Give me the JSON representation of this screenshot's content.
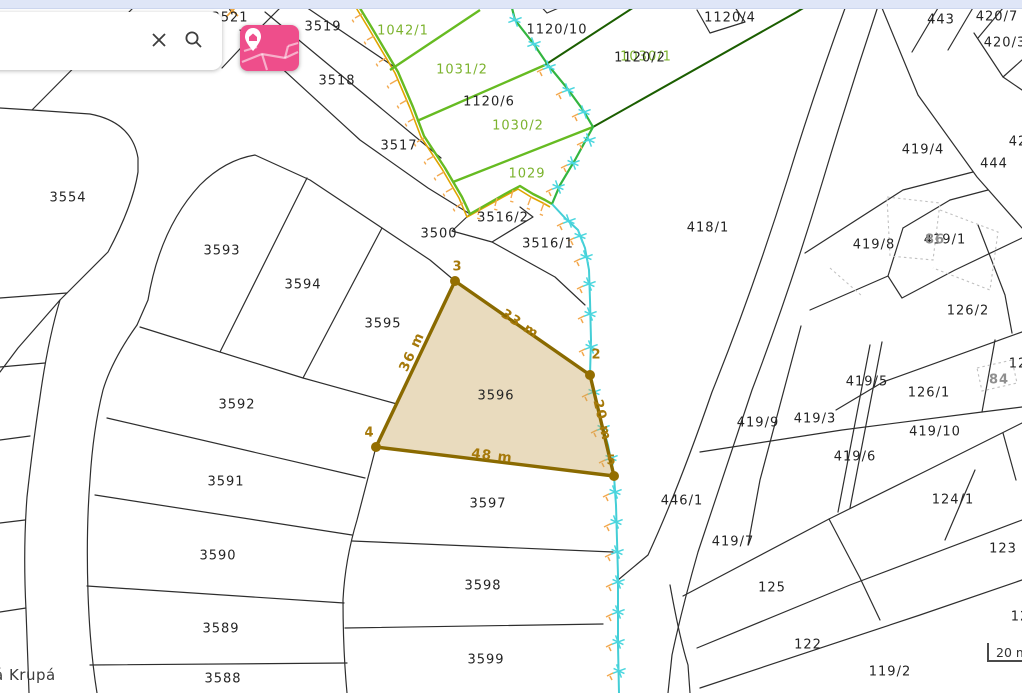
{
  "ui": {
    "search": {
      "placeholder": "",
      "value": "",
      "clear_label": "clear",
      "search_label": "search"
    },
    "map_style_button": {
      "label": "map style / base layer switcher"
    },
    "place_label": "á Krupá",
    "scalebar": {
      "label": "20 m"
    }
  },
  "map": {
    "colors": {
      "parcel_line": "#2e2e2e",
      "green_line": "#66bb22",
      "dark_green_line": "#1b5e00",
      "survey_green": "#33b540",
      "survey_cyan": "#44ced6",
      "marker_cyan": "#4ad6de",
      "tick_orange": "#f3a94f",
      "gold_line": "#e0a400",
      "highlight_stroke": "#8a6a00",
      "highlight_fill": "rgba(201,164,92,0.40)",
      "building_dash": "#c0c0c0"
    },
    "highlight": {
      "parcel_number": "3596",
      "vertices": [
        {
          "n": "3",
          "x": 455,
          "y": 281,
          "lx": 457,
          "ly": 267
        },
        {
          "n": "2",
          "x": 590,
          "y": 375,
          "lx": 596,
          "ly": 355
        },
        {
          "n": "5",
          "x": 614,
          "y": 476,
          "lx": 611,
          "ly": 461
        },
        {
          "n": "4",
          "x": 376,
          "y": 447,
          "lx": 369,
          "ly": 433
        }
      ],
      "measurements": [
        {
          "t": "33 m",
          "x": 520,
          "y": 324,
          "r": 33
        },
        {
          "t": "36 m",
          "x": 412,
          "y": 352,
          "r": -65
        },
        {
          "t": "20 m",
          "x": 602,
          "y": 420,
          "r": 77
        },
        {
          "t": "48 m",
          "x": 492,
          "y": 456,
          "r": 7
        }
      ]
    },
    "labels": [
      {
        "t": "3521",
        "x": 230,
        "y": 18,
        "c": "plabel"
      },
      {
        "t": "3519",
        "x": 323,
        "y": 27,
        "c": "plabel"
      },
      {
        "t": "3518",
        "x": 337,
        "y": 81,
        "c": "plabel"
      },
      {
        "t": "3517",
        "x": 399,
        "y": 146,
        "c": "plabel"
      },
      {
        "t": "3500",
        "x": 439,
        "y": 234,
        "c": "plabel"
      },
      {
        "t": "3516/2",
        "x": 503,
        "y": 218,
        "c": "plabel"
      },
      {
        "t": "3516/1",
        "x": 548,
        "y": 244,
        "c": "plabel"
      },
      {
        "t": "3554",
        "x": 68,
        "y": 198,
        "c": "plabel"
      },
      {
        "t": "3593",
        "x": 222,
        "y": 251,
        "c": "plabel"
      },
      {
        "t": "3594",
        "x": 303,
        "y": 285,
        "c": "plabel"
      },
      {
        "t": "3595",
        "x": 383,
        "y": 324,
        "c": "plabel"
      },
      {
        "t": "3592",
        "x": 237,
        "y": 405,
        "c": "plabel"
      },
      {
        "t": "3591",
        "x": 226,
        "y": 482,
        "c": "plabel"
      },
      {
        "t": "3590",
        "x": 218,
        "y": 556,
        "c": "plabel"
      },
      {
        "t": "3589",
        "x": 221,
        "y": 629,
        "c": "plabel"
      },
      {
        "t": "3588",
        "x": 223,
        "y": 679,
        "c": "plabel"
      },
      {
        "t": "3596",
        "x": 496,
        "y": 396,
        "c": "plabel"
      },
      {
        "t": "3597",
        "x": 488,
        "y": 504,
        "c": "plabel"
      },
      {
        "t": "3598",
        "x": 483,
        "y": 586,
        "c": "plabel"
      },
      {
        "t": "3599",
        "x": 486,
        "y": 660,
        "c": "plabel"
      },
      {
        "t": "1120/6",
        "x": 489,
        "y": 102,
        "c": "plabel"
      },
      {
        "t": "1120/10",
        "x": 557,
        "y": 30,
        "c": "plabel"
      },
      {
        "t": "1030/1",
        "x": 646,
        "y": 57,
        "c": "glabel"
      },
      {
        "t": "1120/2",
        "x": 640,
        "y": 58,
        "c": "plabel"
      },
      {
        "t": "1120/4",
        "x": 730,
        "y": 18,
        "c": "plabel"
      },
      {
        "t": "443",
        "x": 941,
        "y": 20,
        "c": "plabel"
      },
      {
        "t": "420/7",
        "x": 997,
        "y": 17,
        "c": "plabel"
      },
      {
        "t": "420/3",
        "x": 1005,
        "y": 43,
        "c": "plabel"
      },
      {
        "t": "419/4",
        "x": 923,
        "y": 150,
        "c": "plabel"
      },
      {
        "t": "444",
        "x": 994,
        "y": 164,
        "c": "plabel"
      },
      {
        "t": "42",
        "x": 1018,
        "y": 142,
        "c": "plabel"
      },
      {
        "t": "418/1",
        "x": 708,
        "y": 228,
        "c": "plabel"
      },
      {
        "t": "419/8",
        "x": 874,
        "y": 245,
        "c": "plabel"
      },
      {
        "t": "419/1",
        "x": 945,
        "y": 240,
        "c": "plabel"
      },
      {
        "t": "86",
        "x": 935,
        "y": 240,
        "c": "graylabel"
      },
      {
        "t": "126/2",
        "x": 968,
        "y": 311,
        "c": "plabel"
      },
      {
        "t": "419/5",
        "x": 867,
        "y": 382,
        "c": "plabel"
      },
      {
        "t": "126/1",
        "x": 929,
        "y": 393,
        "c": "plabel"
      },
      {
        "t": "84",
        "x": 999,
        "y": 380,
        "c": "graylabel"
      },
      {
        "t": "12",
        "x": 1018,
        "y": 364,
        "c": "plabel"
      },
      {
        "t": "419/9",
        "x": 758,
        "y": 423,
        "c": "plabel"
      },
      {
        "t": "419/3",
        "x": 815,
        "y": 419,
        "c": "plabel"
      },
      {
        "t": "419/10",
        "x": 935,
        "y": 432,
        "c": "plabel"
      },
      {
        "t": "419/6",
        "x": 855,
        "y": 457,
        "c": "plabel"
      },
      {
        "t": "124/1",
        "x": 953,
        "y": 500,
        "c": "plabel"
      },
      {
        "t": "123",
        "x": 1003,
        "y": 549,
        "c": "plabel"
      },
      {
        "t": "446/1",
        "x": 682,
        "y": 501,
        "c": "plabel"
      },
      {
        "t": "419/7",
        "x": 733,
        "y": 542,
        "c": "plabel"
      },
      {
        "t": "125",
        "x": 772,
        "y": 588,
        "c": "plabel"
      },
      {
        "t": "122",
        "x": 808,
        "y": 645,
        "c": "plabel"
      },
      {
        "t": "119/2",
        "x": 890,
        "y": 672,
        "c": "plabel"
      },
      {
        "t": "12",
        "x": 1020,
        "y": 617,
        "c": "plabel"
      },
      {
        "t": "1042/1",
        "x": 403,
        "y": 31,
        "c": "glabel"
      },
      {
        "t": "1031/2",
        "x": 462,
        "y": 70,
        "c": "glabel"
      },
      {
        "t": "1030/2",
        "x": 518,
        "y": 126,
        "c": "glabel"
      },
      {
        "t": "1029",
        "x": 527,
        "y": 174,
        "c": "glabel"
      }
    ]
  }
}
